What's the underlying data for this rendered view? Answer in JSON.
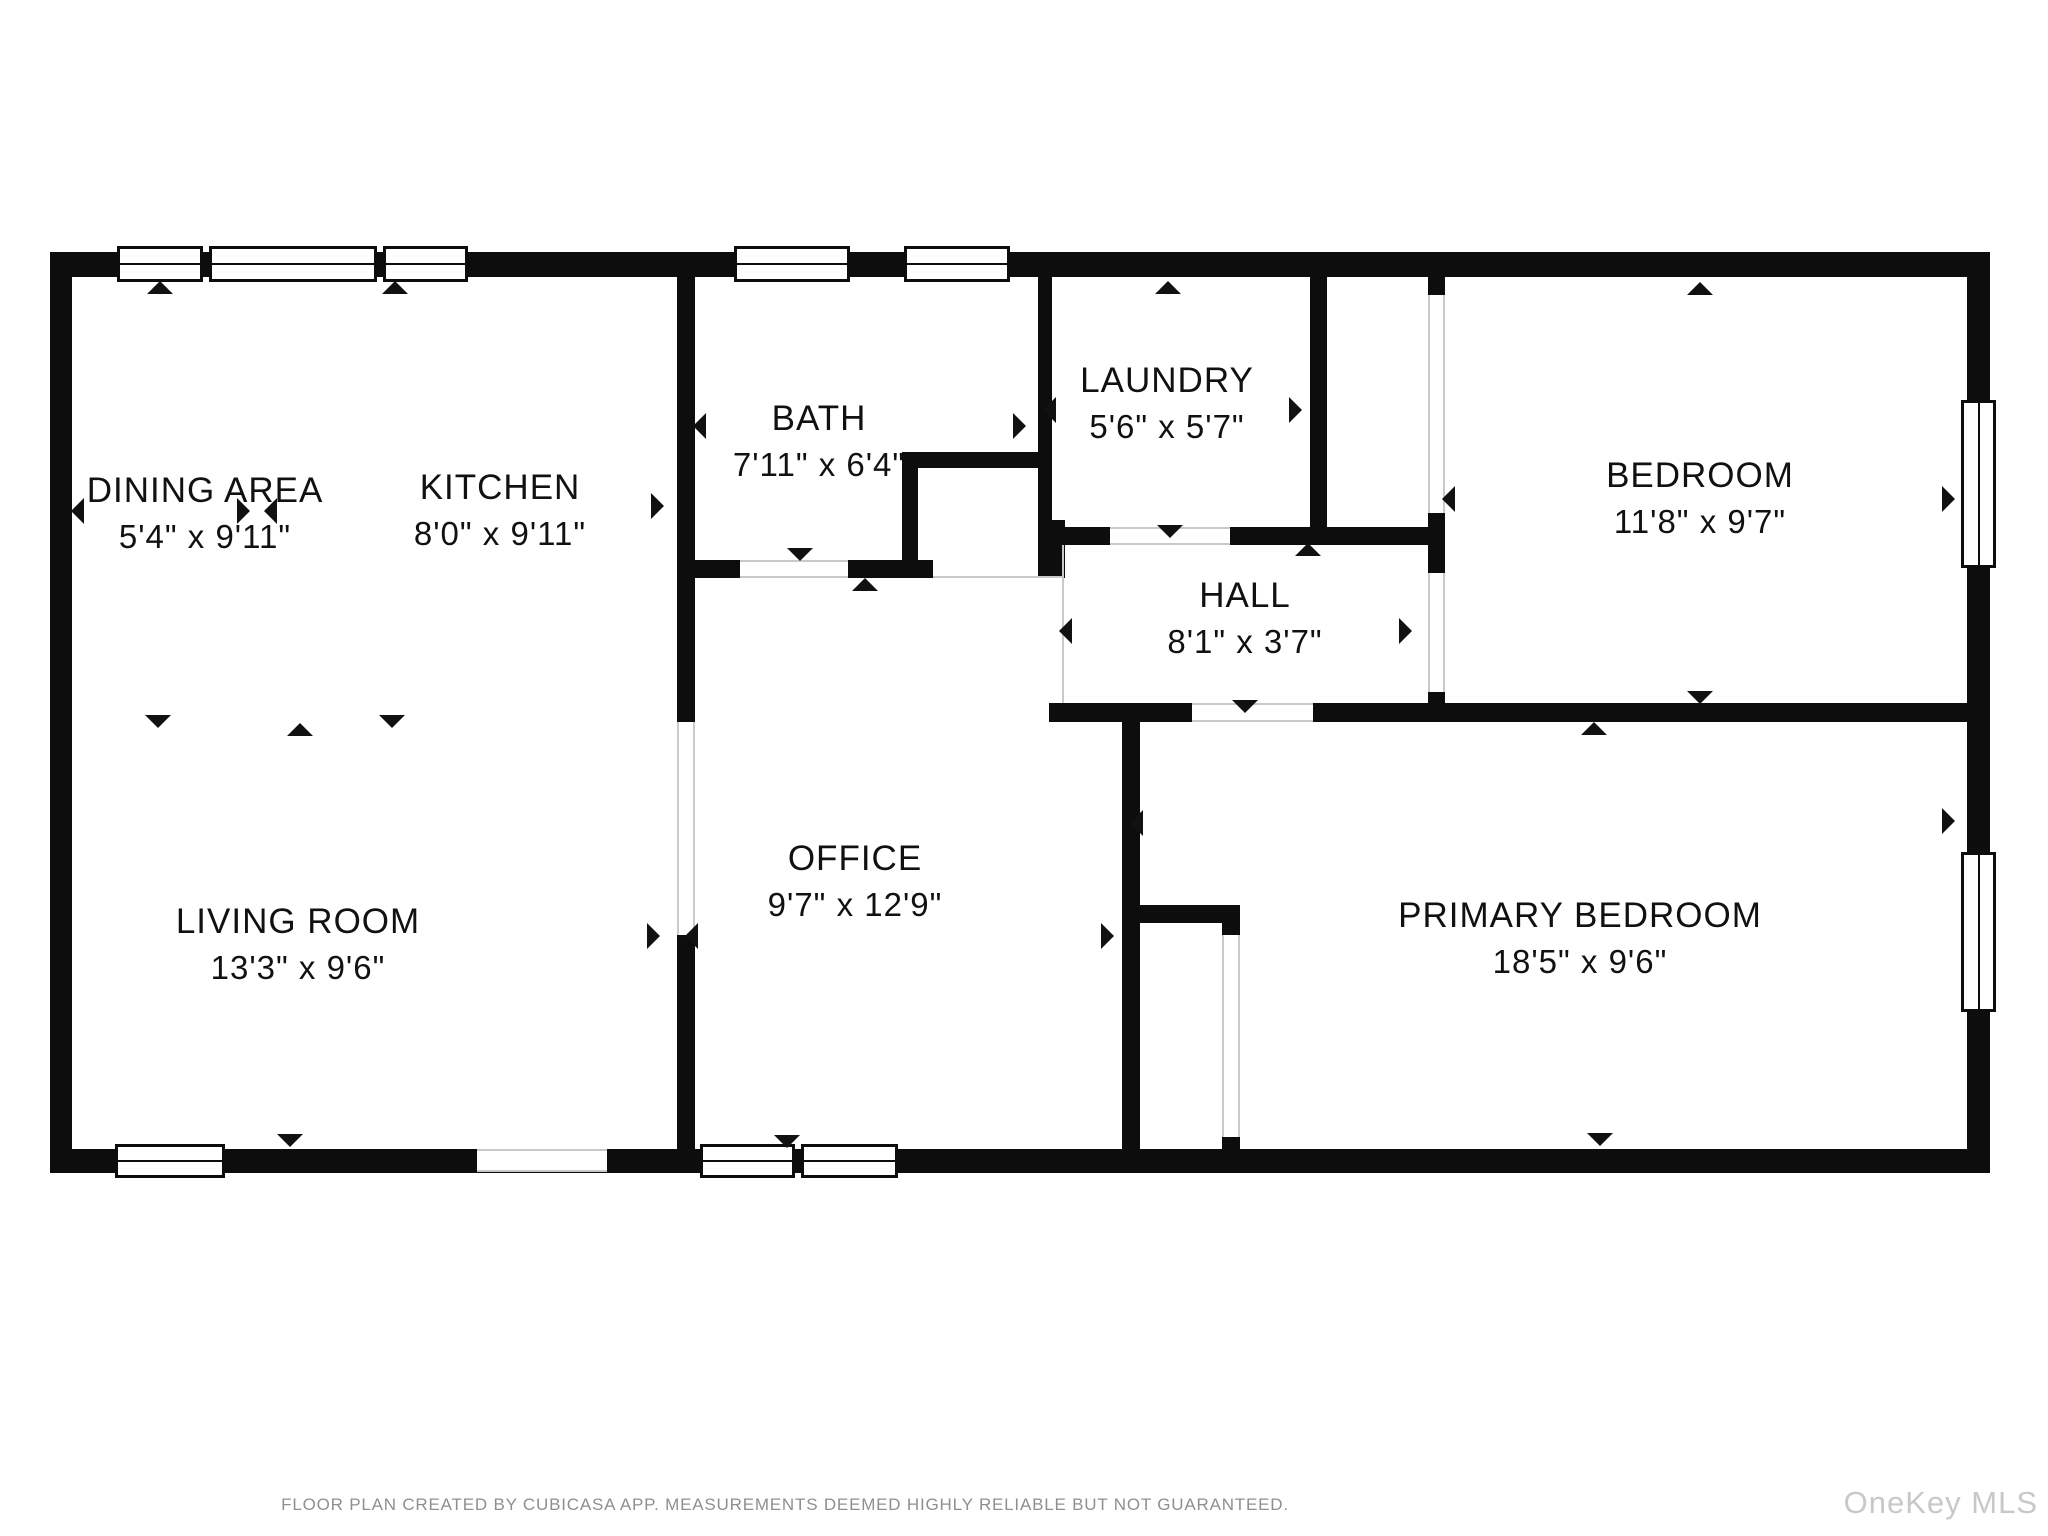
{
  "meta": {
    "footer": "FLOOR PLAN CREATED BY CUBICASA APP. MEASUREMENTS DEEMED HIGHLY RELIABLE BUT NOT GUARANTEED.",
    "watermark": "OneKey MLS",
    "wall_color": "#0d0d0d",
    "text_color": "#111111",
    "footer_color": "#8f8f8f",
    "watermark_color": "#c8c8c8"
  },
  "rooms": [
    {
      "name": "DINING AREA",
      "dims": "5'4\" x 9'11\"",
      "cx": 205,
      "cy": 514
    },
    {
      "name": "KITCHEN",
      "dims": "8'0\" x 9'11\"",
      "cx": 500,
      "cy": 511
    },
    {
      "name": "BATH",
      "dims": "7'11\" x 6'4\"",
      "cx": 819,
      "cy": 442
    },
    {
      "name": "LAUNDRY",
      "dims": "5'6\" x 5'7\"",
      "cx": 1167,
      "cy": 404
    },
    {
      "name": "BEDROOM",
      "dims": "11'8\" x 9'7\"",
      "cx": 1700,
      "cy": 499
    },
    {
      "name": "HALL",
      "dims": "8'1\" x 3'7\"",
      "cx": 1245,
      "cy": 619
    },
    {
      "name": "LIVING ROOM",
      "dims": "13'3\" x 9'6\"",
      "cx": 298,
      "cy": 945
    },
    {
      "name": "OFFICE",
      "dims": "9'7\" x 12'9\"",
      "cx": 855,
      "cy": 882
    },
    {
      "name": "PRIMARY BEDROOM",
      "dims": "18'5\" x 9'6\"",
      "cx": 1580,
      "cy": 939
    }
  ],
  "walls": [
    {
      "n": "outer-top",
      "x": 50,
      "y": 252,
      "w": 1940,
      "h": 25
    },
    {
      "n": "outer-bottom",
      "x": 50,
      "y": 1149,
      "w": 1940,
      "h": 24
    },
    {
      "n": "outer-left",
      "x": 50,
      "y": 252,
      "w": 22,
      "h": 920
    },
    {
      "n": "outer-right",
      "x": 1967,
      "y": 252,
      "w": 23,
      "h": 920
    },
    {
      "n": "kitchen-bath-wall",
      "x": 677,
      "y": 277,
      "w": 18,
      "h": 445
    },
    {
      "n": "living-office-wall",
      "x": 677,
      "y": 935,
      "w": 18,
      "h": 214
    },
    {
      "n": "bath-bottom-left",
      "x": 695,
      "y": 560,
      "w": 45,
      "h": 18
    },
    {
      "n": "bath-bottom-right",
      "x": 848,
      "y": 560,
      "w": 85,
      "h": 18
    },
    {
      "n": "alcove-left",
      "x": 902,
      "y": 452,
      "w": 16,
      "h": 126
    },
    {
      "n": "alcove-top",
      "x": 902,
      "y": 452,
      "w": 150,
      "h": 16
    },
    {
      "n": "bath-laundry-wall",
      "x": 1038,
      "y": 277,
      "w": 14,
      "h": 268
    },
    {
      "n": "bath-laundry-foot",
      "x": 1038,
      "y": 520,
      "w": 27,
      "h": 58
    },
    {
      "n": "hall-top-left",
      "x": 1038,
      "y": 527,
      "w": 72,
      "h": 18
    },
    {
      "n": "hall-top-right",
      "x": 1230,
      "y": 527,
      "w": 198,
      "h": 18
    },
    {
      "n": "laundry-right-wall",
      "x": 1310,
      "y": 277,
      "w": 17,
      "h": 268
    },
    {
      "n": "bedroom-left-stub-top",
      "x": 1428,
      "y": 277,
      "w": 17,
      "h": 23
    },
    {
      "n": "bedroom-left-mid",
      "x": 1428,
      "y": 513,
      "w": 17,
      "h": 60
    },
    {
      "n": "bedroom-left-bottom",
      "x": 1428,
      "y": 692,
      "w": 17,
      "h": 30
    },
    {
      "n": "hall-bottom-left",
      "x": 1049,
      "y": 703,
      "w": 143,
      "h": 19
    },
    {
      "n": "bedroom-primary-divider",
      "x": 1313,
      "y": 703,
      "w": 654,
      "h": 19
    },
    {
      "n": "office-primary-wall",
      "x": 1122,
      "y": 722,
      "w": 18,
      "h": 427
    },
    {
      "n": "closet-top-wall",
      "x": 1138,
      "y": 905,
      "w": 102,
      "h": 18
    },
    {
      "n": "closet-cap",
      "x": 1222,
      "y": 923,
      "w": 18,
      "h": 12
    },
    {
      "n": "closet-stub",
      "x": 1222,
      "y": 1137,
      "w": 18,
      "h": 12
    }
  ],
  "windows": [
    {
      "n": "dining-window-1",
      "x": 117,
      "y": 246,
      "w": 86,
      "h": 36,
      "o": "h"
    },
    {
      "n": "dining-window-2",
      "x": 209,
      "y": 246,
      "w": 168,
      "h": 36,
      "o": "h"
    },
    {
      "n": "kitchen-window",
      "x": 383,
      "y": 246,
      "w": 85,
      "h": 36,
      "o": "h"
    },
    {
      "n": "bath-window-1",
      "x": 734,
      "y": 246,
      "w": 116,
      "h": 36,
      "o": "h"
    },
    {
      "n": "bath-window-2",
      "x": 904,
      "y": 246,
      "w": 106,
      "h": 36,
      "o": "h"
    },
    {
      "n": "living-window",
      "x": 115,
      "y": 1144,
      "w": 110,
      "h": 34,
      "o": "h"
    },
    {
      "n": "office-window-1",
      "x": 700,
      "y": 1144,
      "w": 95,
      "h": 34,
      "o": "h"
    },
    {
      "n": "office-window-2",
      "x": 801,
      "y": 1144,
      "w": 97,
      "h": 34,
      "o": "h"
    },
    {
      "n": "bedroom-window",
      "x": 1961,
      "y": 400,
      "w": 35,
      "h": 168,
      "o": "v"
    },
    {
      "n": "primary-window",
      "x": 1961,
      "y": 852,
      "w": 35,
      "h": 160,
      "o": "v"
    }
  ],
  "openings": [
    {
      "n": "entry-opening",
      "x": 477,
      "y": 1149,
      "w": 130,
      "h": 23
    },
    {
      "n": "living-office-opening",
      "x": 677,
      "y": 722,
      "w": 18,
      "h": 213
    },
    {
      "n": "bath-door",
      "x": 740,
      "y": 560,
      "w": 108,
      "h": 18
    },
    {
      "n": "laundry-door",
      "x": 1110,
      "y": 527,
      "w": 120,
      "h": 18
    },
    {
      "n": "hall-primary-door",
      "x": 1192,
      "y": 703,
      "w": 121,
      "h": 19
    },
    {
      "n": "bedroom-closet-opening",
      "x": 1428,
      "y": 295,
      "w": 17,
      "h": 218
    },
    {
      "n": "hall-bedroom-door",
      "x": 1428,
      "y": 573,
      "w": 17,
      "h": 119
    },
    {
      "n": "primary-closet-door",
      "x": 1222,
      "y": 935,
      "w": 18,
      "h": 202
    }
  ],
  "thin_lines": [
    {
      "n": "hall-left-boundary",
      "x": 1062,
      "y": 545,
      "w": 2,
      "h": 158
    },
    {
      "n": "office-top-boundary",
      "x": 933,
      "y": 576,
      "w": 130,
      "h": 2
    }
  ],
  "arrows": [
    {
      "x": 160,
      "y": 288,
      "d": "up"
    },
    {
      "x": 395,
      "y": 288,
      "d": "up"
    },
    {
      "x": 1168,
      "y": 288,
      "d": "up"
    },
    {
      "x": 1700,
      "y": 289,
      "d": "up"
    },
    {
      "x": 865,
      "y": 585,
      "d": "up"
    },
    {
      "x": 1308,
      "y": 550,
      "d": "up"
    },
    {
      "x": 300,
      "y": 730,
      "d": "up"
    },
    {
      "x": 1594,
      "y": 729,
      "d": "up"
    },
    {
      "x": 158,
      "y": 722,
      "d": "down"
    },
    {
      "x": 392,
      "y": 722,
      "d": "down"
    },
    {
      "x": 800,
      "y": 555,
      "d": "down"
    },
    {
      "x": 1170,
      "y": 532,
      "d": "down"
    },
    {
      "x": 1245,
      "y": 707,
      "d": "down"
    },
    {
      "x": 1700,
      "y": 698,
      "d": "down"
    },
    {
      "x": 290,
      "y": 1141,
      "d": "down"
    },
    {
      "x": 787,
      "y": 1142,
      "d": "down"
    },
    {
      "x": 1600,
      "y": 1140,
      "d": "down"
    },
    {
      "x": 84,
      "y": 505,
      "d": "left"
    },
    {
      "x": 277,
      "y": 505,
      "d": "left"
    },
    {
      "x": 706,
      "y": 420,
      "d": "left"
    },
    {
      "x": 1056,
      "y": 404,
      "d": "left"
    },
    {
      "x": 1072,
      "y": 625,
      "d": "left"
    },
    {
      "x": 698,
      "y": 930,
      "d": "left"
    },
    {
      "x": 1143,
      "y": 817,
      "d": "left"
    },
    {
      "x": 1455,
      "y": 493,
      "d": "left"
    },
    {
      "x": 250,
      "y": 505,
      "d": "right"
    },
    {
      "x": 664,
      "y": 500,
      "d": "right"
    },
    {
      "x": 1026,
      "y": 420,
      "d": "right"
    },
    {
      "x": 1302,
      "y": 404,
      "d": "right"
    },
    {
      "x": 1412,
      "y": 625,
      "d": "right"
    },
    {
      "x": 660,
      "y": 930,
      "d": "right"
    },
    {
      "x": 1114,
      "y": 930,
      "d": "right"
    },
    {
      "x": 1955,
      "y": 493,
      "d": "right"
    },
    {
      "x": 1955,
      "y": 815,
      "d": "right"
    }
  ]
}
